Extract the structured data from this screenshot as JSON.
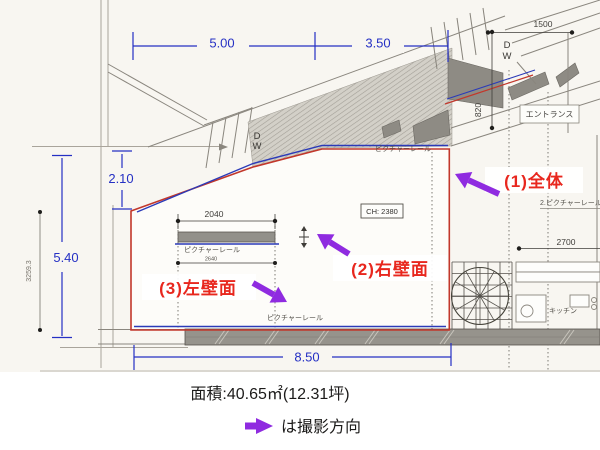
{
  "dimensions": {
    "top_span_left": "5.00",
    "top_span_right": "3.50",
    "entrance_width_mm": "1500",
    "entrance_depth_mm": "820",
    "left_drop": "2.10",
    "left_height": "5.40",
    "left_height_mm": "3259.3",
    "bottom_span": "8.50",
    "right_span_mm": "2700",
    "rail_width_mm": "2040",
    "rail_width2_mm": "2640",
    "ceiling_height": "CH: 2380"
  },
  "room_labels": {
    "entrance": "エントランス",
    "kitchen": "キッチン",
    "picture_rail_top": "ピクチャーレール",
    "picture_rail_detail": "ピクチャーレール",
    "picture_rail_bottom": "ピクチャーレール",
    "picture_rail_no2": "2.ピクチャーレール",
    "door_d": "D",
    "door_w": "W"
  },
  "annotations": {
    "view_1": "(1)全体",
    "view_2": "(2)右壁面",
    "view_3": "(3)左壁面"
  },
  "caption": {
    "area": "面積:40.65㎡(12.31坪)",
    "legend": "は撮影方向"
  },
  "colors": {
    "dimension_blue": "#2530c4",
    "outline_red": "#c2372b",
    "annotation_red": "#e8271e",
    "arrow_purple": "#8f2be0",
    "rail_blue": "#2b3ab8"
  }
}
